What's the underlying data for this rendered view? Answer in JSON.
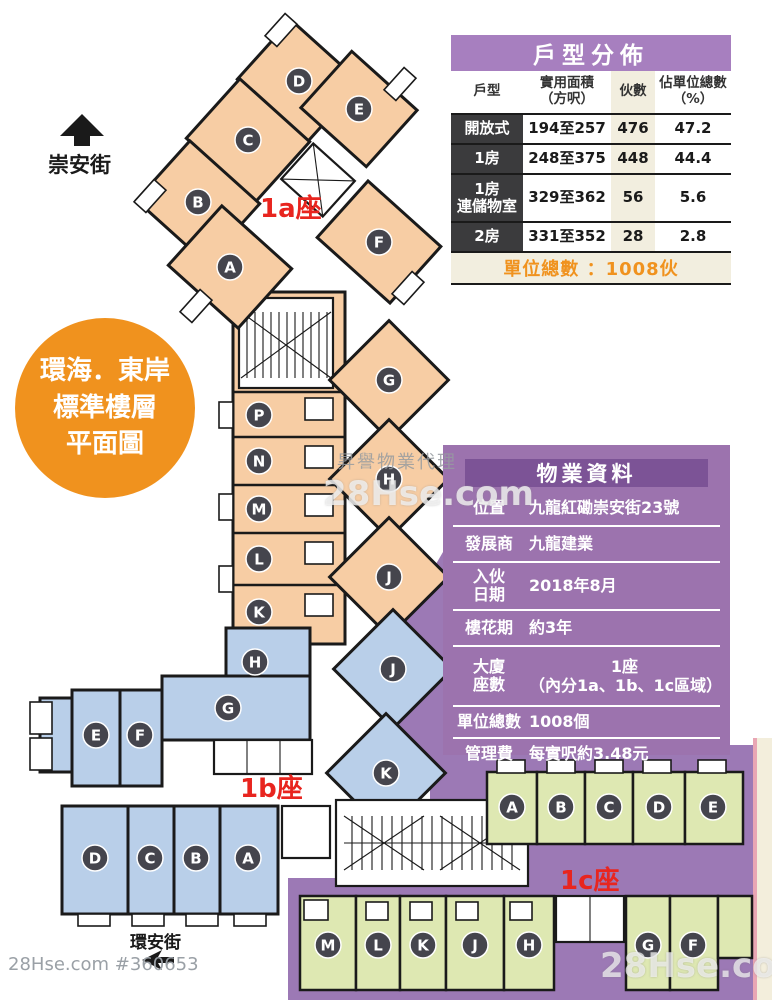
{
  "unit_table": {
    "title": "戶型分佈",
    "headers": {
      "type": "戶型",
      "area": "實用面積\n（方呎）",
      "count": "伙數",
      "share": "佔單位總數\n（%）"
    },
    "rows": [
      {
        "type": "開放式",
        "area": "194至257",
        "count": "476",
        "share": "47.2"
      },
      {
        "type": "1房",
        "area": "248至375",
        "count": "448",
        "share": "44.4"
      },
      {
        "type": "1房\n連儲物室",
        "area": "329至362",
        "count": "56",
        "share": "5.6"
      },
      {
        "type": "2房",
        "area": "331至352",
        "count": "28",
        "share": "2.8"
      }
    ],
    "footer": "單位總數 ：1008伙"
  },
  "property_table": {
    "title": "物業資料",
    "rows": [
      {
        "label": "位置",
        "value": "九龍紅磡崇安街23號"
      },
      {
        "label": "發展商",
        "value": "九龍建業"
      },
      {
        "label": "入伙\n日期",
        "value": "2018年8月"
      },
      {
        "label": "樓花期",
        "value": "約3年"
      },
      {
        "label": "大廈\n座數",
        "value": "1座",
        "value2": "（內分1a、1b、1c區域）"
      },
      {
        "label": "單位總數",
        "value": "1008個"
      },
      {
        "label": "管理費",
        "value": "每實呎約3.48元"
      }
    ]
  },
  "badge": {
    "line1": "環海．東岸",
    "line2": "標準樓層",
    "line3": "平面圖"
  },
  "plan": {
    "labels": {
      "wing_1a": "1a座",
      "wing_1b": "1b座",
      "wing_1c": "1c座",
      "street_top": "崇安街",
      "street_bottom": "環安街"
    },
    "units_1a": [
      "D",
      "E",
      "C",
      "B",
      "A",
      "F"
    ],
    "units_corridor": [
      "P",
      "N",
      "M",
      "L",
      "K"
    ],
    "units_diag_orange": [
      "G",
      "H",
      "J"
    ],
    "units_1b": {
      "top": [
        "H",
        "G",
        "E",
        "F"
      ],
      "bottom": [
        "D",
        "C",
        "B",
        "A"
      ],
      "diag": [
        "J",
        "K"
      ]
    },
    "units_1c": {
      "top": [
        "A",
        "B",
        "C",
        "D",
        "E"
      ],
      "bottom": [
        "M",
        "L",
        "K",
        "J",
        "H",
        "G",
        "F"
      ]
    }
  },
  "watermarks": {
    "agency": "昇譽物業代理",
    "logo_center": "28Hse.com",
    "logo_bottom_right": "28Hse.com",
    "listing_id": "28Hse.com #360653"
  },
  "colors": {
    "orange_unit": "#F7CDA4",
    "blue_unit": "#B9CFE9",
    "green_unit": "#DEE8B2",
    "podium_purple": "#9C79B5",
    "accent_red": "#E8251F",
    "badge_orange": "#F0921E",
    "table_title_purple": "#A77FBF",
    "property_bg_purple": "#9C73AE",
    "property_header_purple": "#7C5396"
  }
}
